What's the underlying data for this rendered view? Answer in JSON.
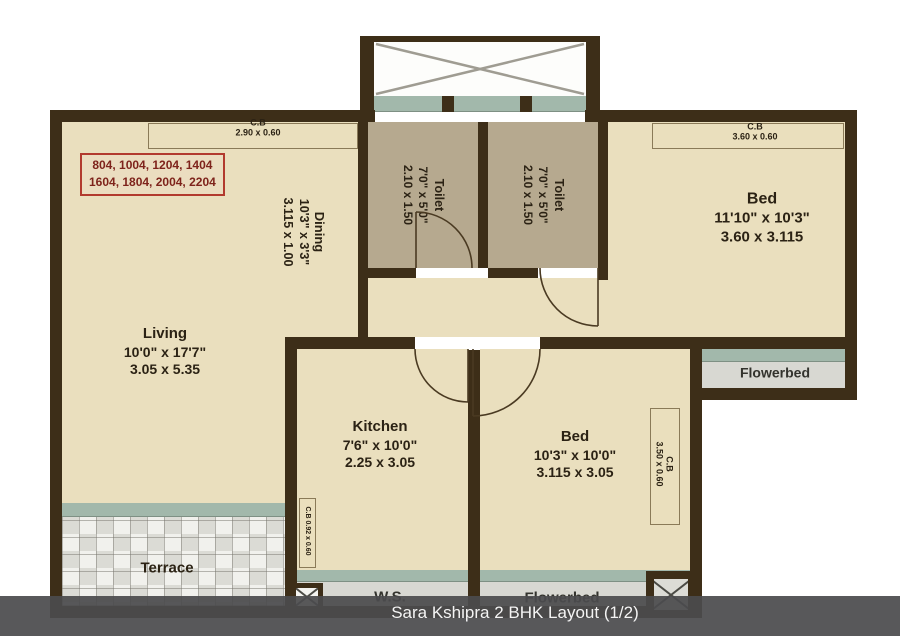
{
  "caption": "Sara Kshipra 2 BHK Layout (1/2)",
  "unit_box": {
    "line1": "804, 1004, 1204, 1404",
    "line2": "1604, 1804, 2004, 2204"
  },
  "rooms": {
    "living": {
      "name": "Living",
      "imperial": "10'0\" x 17'7\"",
      "metric": "3.05 x 5.35"
    },
    "dining": {
      "name": "Dining",
      "imperial": "10'3\" x 3'3\"",
      "metric": "3.115 x 1.00"
    },
    "toilet1": {
      "name": "Toilet",
      "imperial": "7'0\" x 5'0\"",
      "metric": "2.10 x 1.50"
    },
    "toilet2": {
      "name": "Toilet",
      "imperial": "7'0\" x 5'0\"",
      "metric": "2.10 x 1.50"
    },
    "bed1": {
      "name": "Bed",
      "imperial": "11'10\" x 10'3\"",
      "metric": "3.60 x 3.115"
    },
    "bed2": {
      "name": "Bed",
      "imperial": "10'3\" x 10'0\"",
      "metric": "3.115 x 3.05"
    },
    "kitchen": {
      "name": "Kitchen",
      "imperial": "7'6\" x 10'0\"",
      "metric": "2.25 x 3.05"
    },
    "terrace": {
      "name": "Terrace"
    },
    "ws": {
      "name": "W.S."
    },
    "flowerbed_right": {
      "name": "Flowerbed"
    },
    "flowerbed_bottom": {
      "name": "Flowerbed"
    }
  },
  "cupboards": {
    "top_left": {
      "label": "C.B",
      "size": "2.90 x 0.60"
    },
    "top_right": {
      "label": "C.B",
      "size": "3.60 x 0.60"
    },
    "bed2_side": {
      "label": "C.B",
      "size": "3.50 x 0.60"
    },
    "kitchen_side": {
      "label": "C.B 0.92 x 0.60"
    }
  },
  "colors": {
    "wall": "#3d2e18",
    "floor": "#eadfbe",
    "toilet_floor": "#b6a98f",
    "window_sill": "#a2b8ab",
    "flowerbed_strip": "#d8d8d2",
    "unit_box_red": "#b23a2e",
    "caption_bar": "#4b4b4d",
    "label_text": "#2b2214"
  }
}
